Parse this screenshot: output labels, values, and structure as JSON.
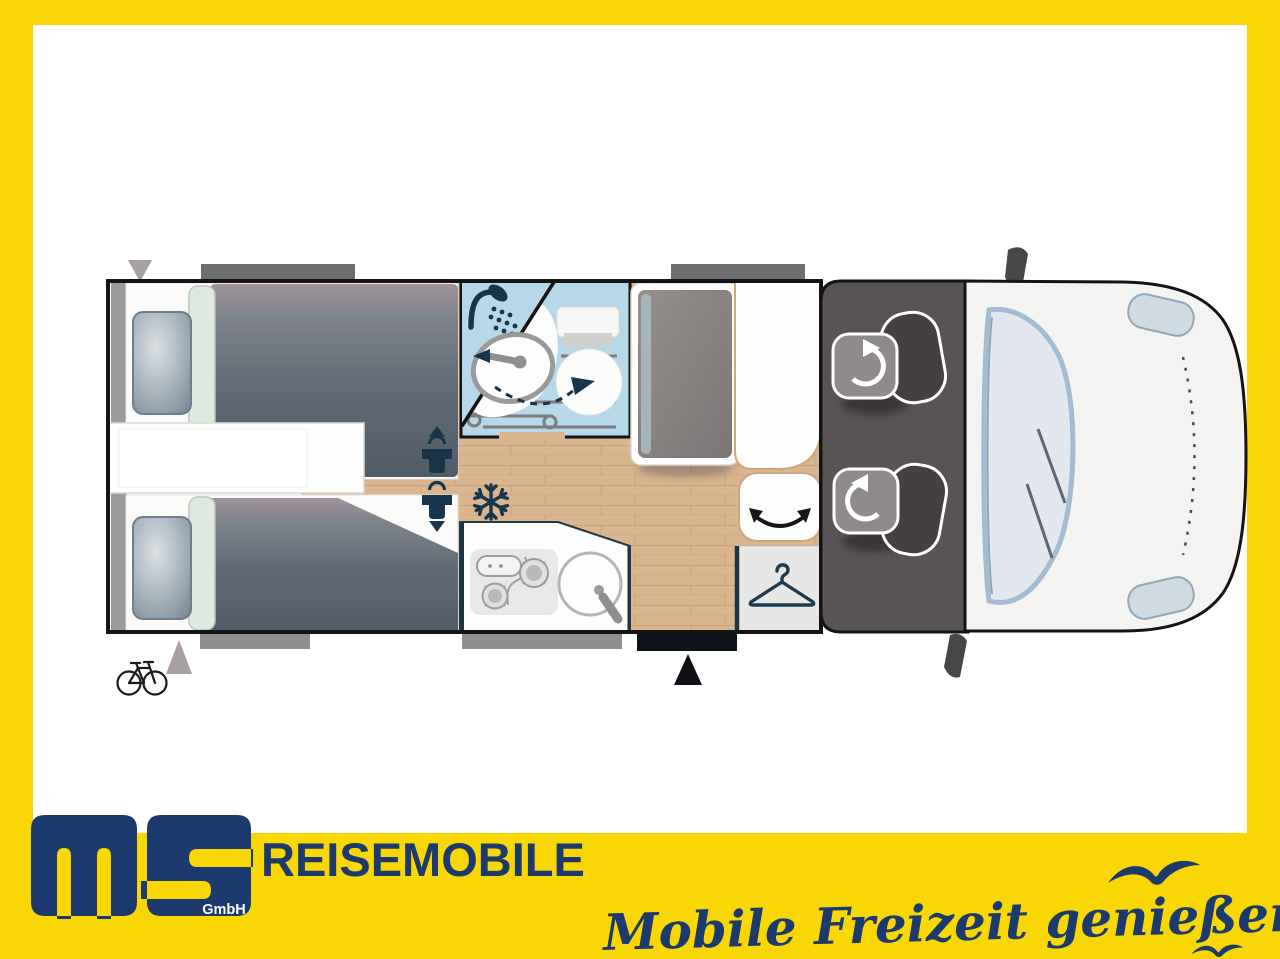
{
  "brand": {
    "logo_text": "ms",
    "logo_sub": "GmbH",
    "wordmark": "REISEMOBILE",
    "tagline": "Mobile Freizeit genießen."
  },
  "colors": {
    "frame_yellow": "#F8D705",
    "brand_navy": "#1C3A6D",
    "icon_navy": "#17364C",
    "bathroom_blue": "#B6D8E8",
    "wood_floor": "#D9B68F",
    "cab_gray": "#595356",
    "mattress_slate": "#5A646E",
    "vehicle_body": "#F3F3F1",
    "windshield_blue": "#E2E8ED",
    "window_gray": "#6E6E6E",
    "entry_step_black": "#10141A"
  },
  "floorplan": {
    "icons": {
      "shower-icon": "shower head with water drops",
      "sink-swivel-arrow-icon": "dashed swivel arc with arrows",
      "snowflake-icon": "❄",
      "clothes-hanger-icon": "wardrobe hanger",
      "bicycle-icon": "bike storage",
      "person-clearance-icons": "standing-height figures with arrows",
      "seat-rotation-arrow-icons": "cab seat swivel arrows",
      "bench-swivel-arrow-icon": "curved double arrow",
      "entry-door-marker": "▲",
      "rear-marker-top": "▼",
      "rear-marker-bottom": "▲"
    }
  }
}
